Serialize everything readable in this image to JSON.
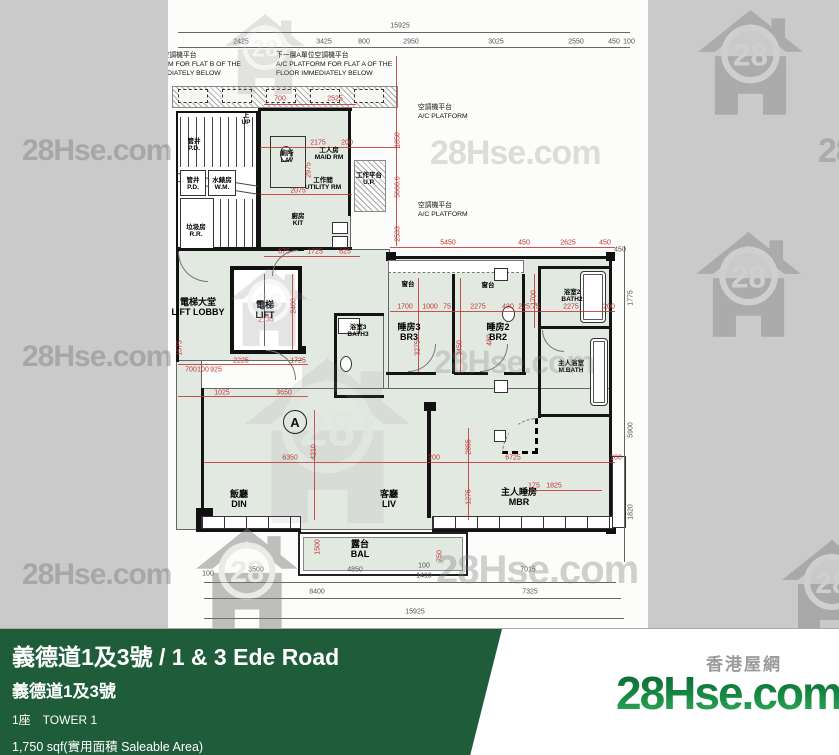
{
  "footer": {
    "title": "義德道1及3號 / 1 & 3 Ede Road",
    "subtitle": "義德道1及3號",
    "tower": "1座　TOWER 1",
    "area": "1,750 sqf(實用面積 Saleable Area)",
    "accent_green": "#1f5c3a"
  },
  "logo": {
    "site_zh": "香港屋網",
    "brand": "28Hse.com",
    "number": "28"
  },
  "watermarks": {
    "text": "28Hse.com",
    "number": "28",
    "items": [
      {
        "k": "logo",
        "x": 225,
        "y": 14,
        "s": 80,
        "o": 0.2
      },
      {
        "k": "logo",
        "x": 698,
        "y": 10,
        "s": 105,
        "o": 0.4
      },
      {
        "k": "text",
        "x": 22,
        "y": 136,
        "s": 30,
        "o": 0.45
      },
      {
        "k": "text",
        "x": 430,
        "y": 136,
        "s": 34,
        "o": 0.25
      },
      {
        "k": "text",
        "x": 818,
        "y": 134,
        "s": 34,
        "o": 0.4
      },
      {
        "k": "logo",
        "x": 230,
        "y": 268,
        "s": 78,
        "o": 0.2
      },
      {
        "k": "logo",
        "x": 696,
        "y": 232,
        "s": 105,
        "o": 0.4
      },
      {
        "k": "text",
        "x": 22,
        "y": 342,
        "s": 30,
        "o": 0.45
      },
      {
        "k": "text",
        "x": 434,
        "y": 346,
        "s": 32,
        "o": 0.26
      },
      {
        "k": "logo",
        "x": 245,
        "y": 358,
        "s": 165,
        "o": 0.1
      },
      {
        "k": "logo",
        "x": 196,
        "y": 528,
        "s": 102,
        "o": 0.48
      },
      {
        "k": "text",
        "x": 22,
        "y": 560,
        "s": 30,
        "o": 0.45
      },
      {
        "k": "text",
        "x": 436,
        "y": 550,
        "s": 40,
        "o": 0.35
      },
      {
        "k": "logo",
        "x": 782,
        "y": 540,
        "s": 100,
        "o": 0.42
      }
    ]
  },
  "plan": {
    "flat_label": "A",
    "annotations": [
      {
        "x": -44,
        "y": 52,
        "lines": [
          "下一層B單位空調機平台",
          "A/C PLATFORM FOR FLAT B OF THE",
          "FLOOR IMMEDIATELY BELOW"
        ]
      },
      {
        "x": 108,
        "y": 52,
        "lines": [
          "下一層A單位空調機平台",
          "A/C PLATFORM FOR FLAT A OF THE",
          "FLOOR IMMEDIATELY BELOW"
        ]
      },
      {
        "x": 250,
        "y": 104,
        "lines": [
          "空調機平台",
          "A/C PLATFORM"
        ]
      },
      {
        "x": 250,
        "y": 202,
        "lines": [
          "空調機平台",
          "A/C PLATFORM"
        ]
      }
    ],
    "rooms": [
      {
        "zh": "電梯大堂",
        "en": "LIFT LOBBY",
        "x": 30,
        "y": 297
      },
      {
        "zh": "電梯",
        "en": "LIFT",
        "x": 97,
        "y": 300
      },
      {
        "zh": "廁所",
        "en": "LAV",
        "x": 119,
        "y": 150,
        "s": 1
      },
      {
        "zh": "工人房",
        "en": "MAID RM",
        "x": 161,
        "y": 147,
        "s": 1
      },
      {
        "zh": "工作間",
        "en": "UTILITY RM",
        "x": 155,
        "y": 177,
        "s": 1
      },
      {
        "zh": "工作平台",
        "en": "U.P.",
        "x": 201,
        "y": 172,
        "s": 1
      },
      {
        "zh": "廚房",
        "en": "KIT",
        "x": 130,
        "y": 213,
        "s": 1
      },
      {
        "zh": "浴室3",
        "en": "BATH3",
        "x": 190,
        "y": 324,
        "s": 1
      },
      {
        "zh": "睡房3",
        "en": "BR3",
        "x": 241,
        "y": 322
      },
      {
        "zh": "睡房2",
        "en": "BR2",
        "x": 330,
        "y": 322
      },
      {
        "zh": "浴室2",
        "en": "BATH2",
        "x": 404,
        "y": 289,
        "s": 1
      },
      {
        "zh": "主人浴室",
        "en": "M.BATH",
        "x": 403,
        "y": 360,
        "s": 1
      },
      {
        "zh": "飯廳",
        "en": "DIN",
        "x": 71,
        "y": 489
      },
      {
        "zh": "客廳",
        "en": "LIV",
        "x": 221,
        "y": 489
      },
      {
        "zh": "主人睡房",
        "en": "MBR",
        "x": 351,
        "y": 487
      },
      {
        "zh": "露台",
        "en": "BAL",
        "x": 192,
        "y": 539
      },
      {
        "zh": "管井",
        "en": "P.D.",
        "x": 26,
        "y": 138,
        "s": 1
      },
      {
        "zh": "管井",
        "en": "P.D.",
        "x": 25,
        "y": 177,
        "s": 1
      },
      {
        "zh": "水錶房",
        "en": "W.M.",
        "x": 54,
        "y": 177,
        "s": 1
      },
      {
        "zh": "垃圾房",
        "en": "R.R.",
        "x": 28,
        "y": 224,
        "s": 1
      },
      {
        "zh": "上",
        "en": "UP",
        "x": 78,
        "y": 112,
        "s": 1
      },
      {
        "zh": "窗台",
        "en": "",
        "x": 240,
        "y": 281,
        "s": 1
      },
      {
        "zh": "窗台",
        "en": "",
        "x": 320,
        "y": 282,
        "s": 1
      }
    ],
    "dims": [
      {
        "t": "15925",
        "x": 232,
        "y": 26,
        "d": 1
      },
      {
        "t": "2425",
        "x": 73,
        "y": 42,
        "d": 1
      },
      {
        "t": "3425",
        "x": 156,
        "y": 42,
        "d": 1
      },
      {
        "t": "800",
        "x": 196,
        "y": 42,
        "d": 1
      },
      {
        "t": "2950",
        "x": 243,
        "y": 42,
        "d": 1
      },
      {
        "t": "3025",
        "x": 328,
        "y": 42,
        "d": 1
      },
      {
        "t": "2550",
        "x": 408,
        "y": 42,
        "d": 1
      },
      {
        "t": "450",
        "x": 446,
        "y": 42,
        "d": 1
      },
      {
        "t": "100",
        "x": 461,
        "y": 42,
        "d": 1
      },
      {
        "t": "700",
        "x": 112,
        "y": 99
      },
      {
        "t": "2525",
        "x": 167,
        "y": 99
      },
      {
        "t": "1850",
        "x": 230,
        "y": 140,
        "r": 1
      },
      {
        "t": "5666.6",
        "x": 230,
        "y": 187,
        "r": 1
      },
      {
        "t": "2533",
        "x": 230,
        "y": 234,
        "r": 1
      },
      {
        "t": "2175",
        "x": 150,
        "y": 143
      },
      {
        "t": "200",
        "x": 179,
        "y": 143
      },
      {
        "t": "2975",
        "x": 141,
        "y": 170,
        "r": 1
      },
      {
        "t": "2075",
        "x": 130,
        "y": 191
      },
      {
        "t": "675",
        "x": 116,
        "y": 252
      },
      {
        "t": "1725",
        "x": 147,
        "y": 252
      },
      {
        "t": "625",
        "x": 177,
        "y": 252
      },
      {
        "t": "2135",
        "x": 98,
        "y": 320
      },
      {
        "t": "2400",
        "x": 126,
        "y": 306,
        "r": 1
      },
      {
        "t": "2225",
        "x": 73,
        "y": 361
      },
      {
        "t": "1725",
        "x": 130,
        "y": 361
      },
      {
        "t": "1025",
        "x": 54,
        "y": 393
      },
      {
        "t": "3650",
        "x": 116,
        "y": 393
      },
      {
        "t": "1575",
        "x": 12,
        "y": 348,
        "r": 1
      },
      {
        "t": "700",
        "x": 23,
        "y": 370
      },
      {
        "t": "100",
        "x": 35,
        "y": 370
      },
      {
        "t": "925",
        "x": 48,
        "y": 370
      },
      {
        "t": "5450",
        "x": 280,
        "y": 243
      },
      {
        "t": "450",
        "x": 356,
        "y": 243
      },
      {
        "t": "2625",
        "x": 400,
        "y": 243
      },
      {
        "t": "450",
        "x": 437,
        "y": 243
      },
      {
        "t": "1700",
        "x": 237,
        "y": 307
      },
      {
        "t": "1000",
        "x": 262,
        "y": 307
      },
      {
        "t": "75",
        "x": 279,
        "y": 307
      },
      {
        "t": "2275",
        "x": 310,
        "y": 307
      },
      {
        "t": "430",
        "x": 340,
        "y": 307
      },
      {
        "t": "225,75",
        "x": 361,
        "y": 307
      },
      {
        "t": "2275",
        "x": 403,
        "y": 307
      },
      {
        "t": "200",
        "x": 441,
        "y": 307
      },
      {
        "t": "3275",
        "x": 250,
        "y": 348,
        "r": 1
      },
      {
        "t": "3450",
        "x": 292,
        "y": 348,
        "r": 1
      },
      {
        "t": "480",
        "x": 322,
        "y": 340,
        "r": 1
      },
      {
        "t": "1700",
        "x": 366,
        "y": 298,
        "r": 1
      },
      {
        "t": "6350",
        "x": 122,
        "y": 458
      },
      {
        "t": "4210",
        "x": 146,
        "y": 452,
        "r": 1
      },
      {
        "t": "200",
        "x": 266,
        "y": 458
      },
      {
        "t": "2855",
        "x": 301,
        "y": 447,
        "r": 1
      },
      {
        "t": "1275",
        "x": 301,
        "y": 497,
        "r": 1
      },
      {
        "t": "6725",
        "x": 345,
        "y": 458
      },
      {
        "t": "200",
        "x": 448,
        "y": 458
      },
      {
        "t": "175",
        "x": 366,
        "y": 486
      },
      {
        "t": "1825",
        "x": 386,
        "y": 486
      },
      {
        "t": "1500",
        "x": 150,
        "y": 547,
        "r": 1
      },
      {
        "t": "750",
        "x": 272,
        "y": 556,
        "r": 1
      },
      {
        "t": "100",
        "x": 40,
        "y": 574,
        "d": 1
      },
      {
        "t": "3500",
        "x": 88,
        "y": 570,
        "d": 1
      },
      {
        "t": "4850",
        "x": 187,
        "y": 570,
        "d": 1
      },
      {
        "t": "100",
        "x": 256,
        "y": 566,
        "d": 1
      },
      {
        "t": "1410",
        "x": 256,
        "y": 576,
        "d": 1
      },
      {
        "t": "7015",
        "x": 360,
        "y": 570,
        "d": 1
      },
      {
        "t": "8400",
        "x": 149,
        "y": 592,
        "d": 1
      },
      {
        "t": "7325",
        "x": 362,
        "y": 592,
        "d": 1
      },
      {
        "t": "15925",
        "x": 247,
        "y": 612,
        "d": 1
      },
      {
        "t": "450",
        "x": 452,
        "y": 250,
        "d": 1
      },
      {
        "t": "1775",
        "x": 463,
        "y": 298,
        "r": 1,
        "d": 1
      },
      {
        "t": "5900",
        "x": 463,
        "y": 430,
        "r": 1,
        "d": 1
      },
      {
        "t": "1820",
        "x": 463,
        "y": 512,
        "r": 1,
        "d": 1
      }
    ]
  }
}
